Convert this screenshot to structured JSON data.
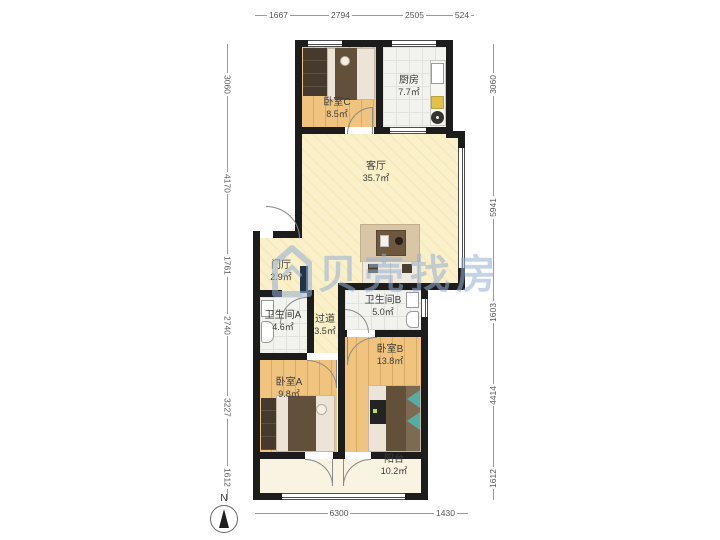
{
  "watermark": {
    "text": "贝壳找房"
  },
  "compass": {
    "label": "N"
  },
  "rooms": [
    {
      "name": "卧室C",
      "area": "8.5㎡"
    },
    {
      "name": "厨房",
      "area": "7.7㎡"
    },
    {
      "name": "客厅",
      "area": "35.7㎡"
    },
    {
      "name": "门厅",
      "area": "2.9㎡"
    },
    {
      "name": "卫生间A",
      "area": "4.6㎡"
    },
    {
      "name": "过道",
      "area": "3.5㎡"
    },
    {
      "name": "卫生间B",
      "area": "5.0㎡"
    },
    {
      "name": "卧室B",
      "area": "13.8㎡"
    },
    {
      "name": "卧室A",
      "area": "9.8㎡"
    },
    {
      "name": "阳台",
      "area": "10.2㎡"
    }
  ],
  "dimensions": {
    "top": [
      "1667",
      "2794",
      "2505",
      "524"
    ],
    "left": [
      "3060",
      "4170",
      "1761",
      "2740",
      "3227",
      "1612"
    ],
    "right": [
      "3060",
      "5941",
      "1603",
      "4414",
      "1612"
    ],
    "bottom": [
      "6300",
      "1430"
    ]
  }
}
